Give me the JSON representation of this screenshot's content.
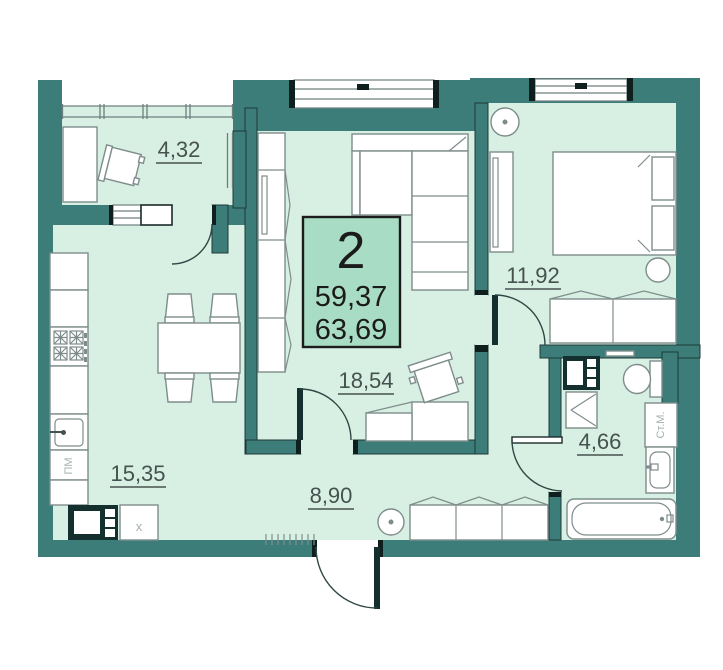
{
  "unit": {
    "rooms_count": "2",
    "living_area": "59,37",
    "total_area": "63,69"
  },
  "rooms": [
    {
      "name": "balcony",
      "area": "4,32"
    },
    {
      "name": "kitchen-dining",
      "area": "15,35"
    },
    {
      "name": "living-room",
      "area": "18,54"
    },
    {
      "name": "bedroom",
      "area": "11,92"
    },
    {
      "name": "hallway",
      "area": "8,90"
    },
    {
      "name": "bathroom",
      "area": "4,66"
    }
  ],
  "appliances": {
    "dishwasher_label": "ПМ",
    "washing_machine_label": "Ст.М.",
    "fridge_label": "x"
  },
  "colors": {
    "wall": "#3C7C79",
    "floor": "#D8EFE3",
    "info_box": "#A9DCC4"
  }
}
